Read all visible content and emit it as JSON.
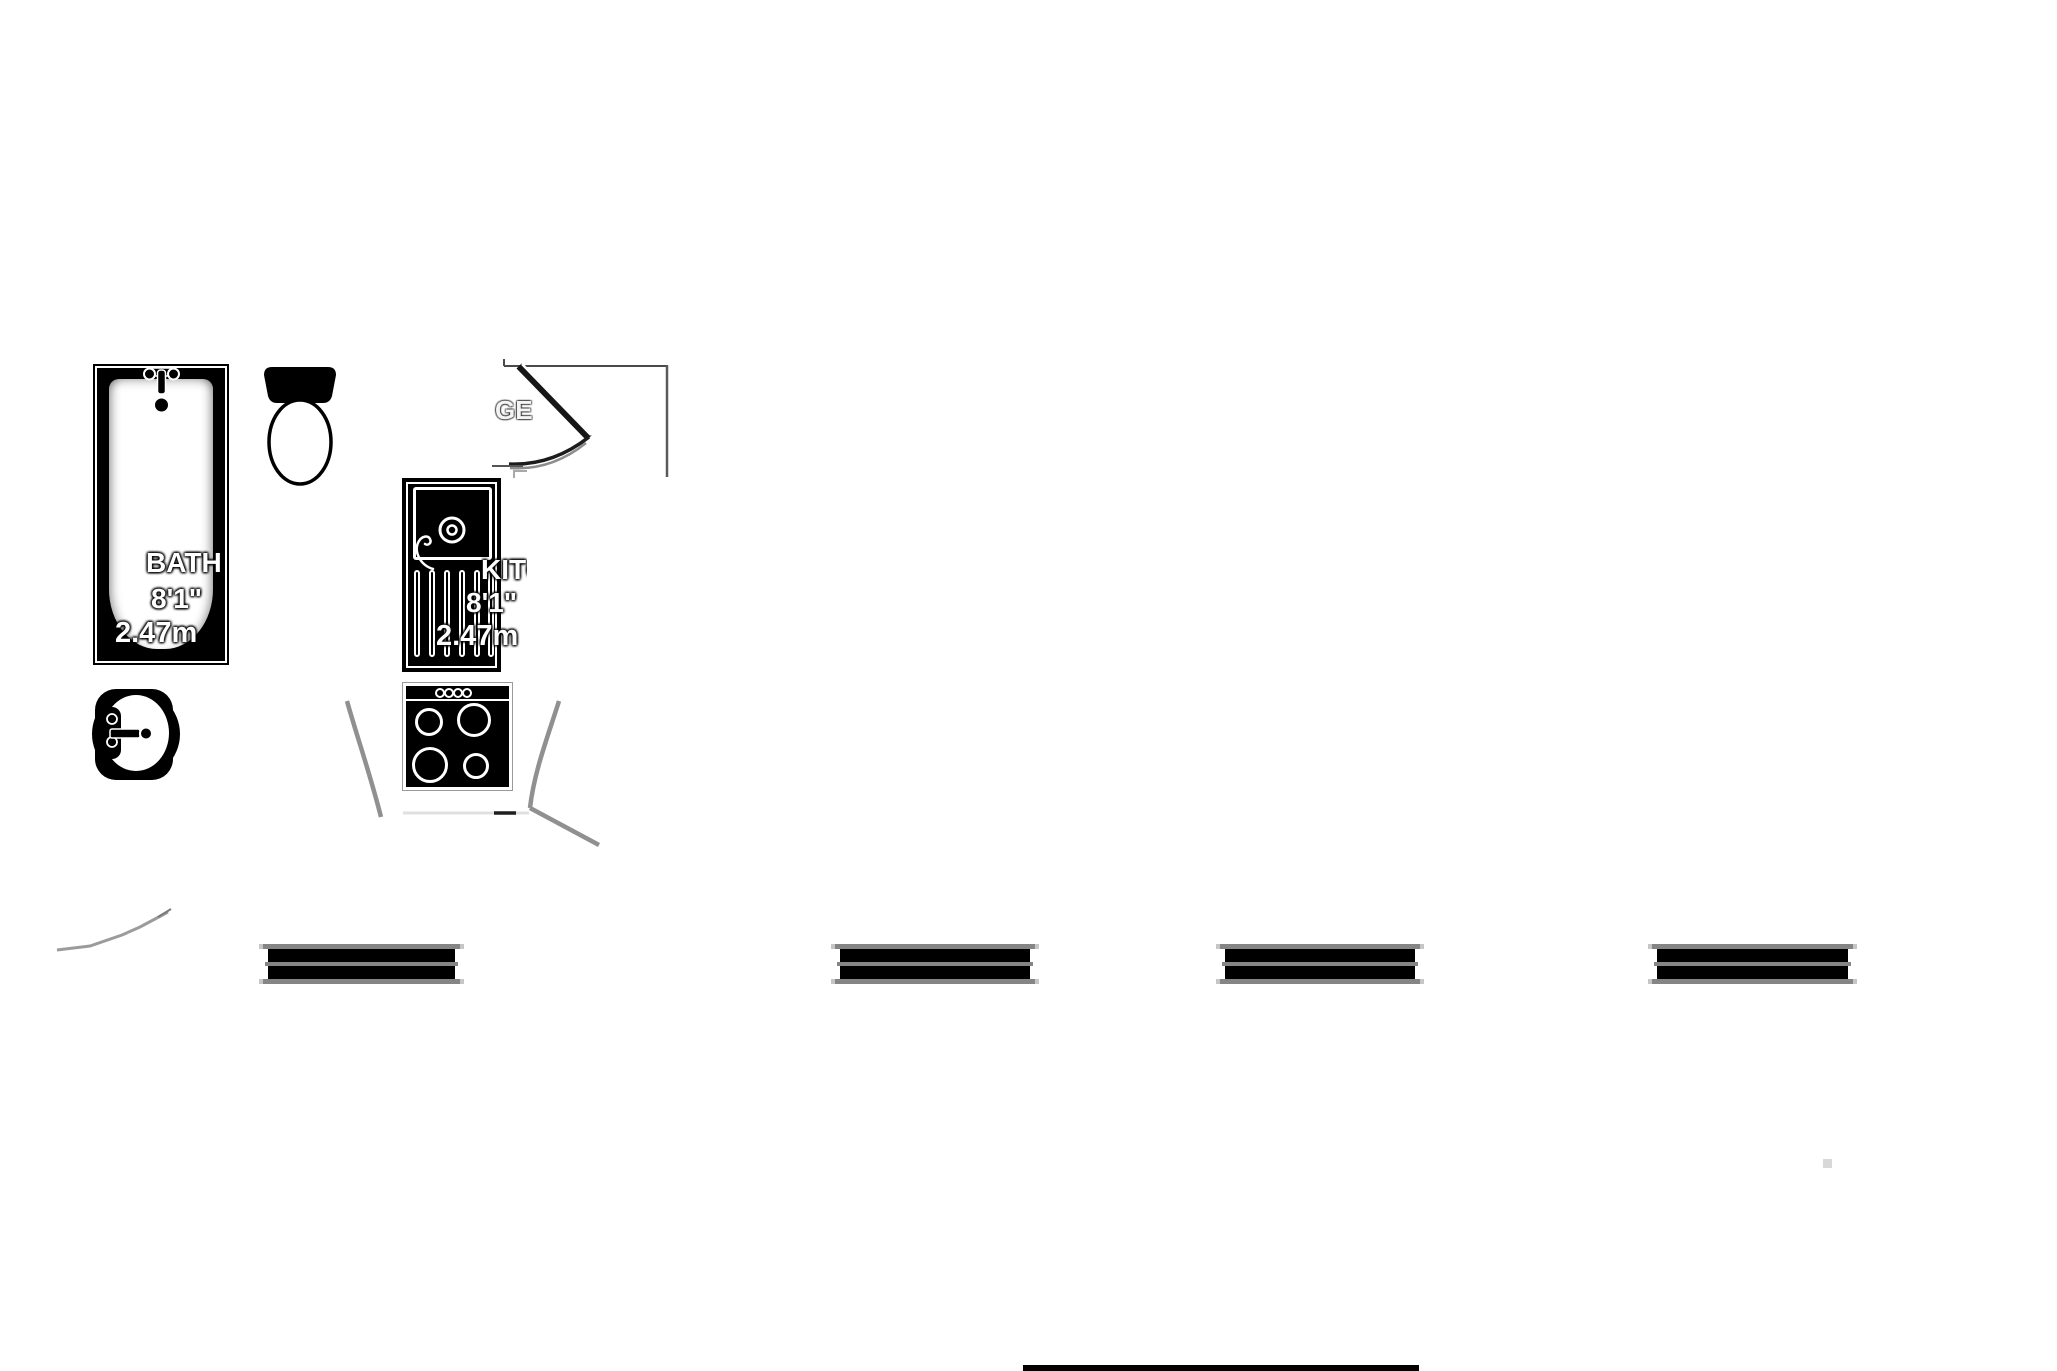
{
  "page": {
    "background": "#ffffff",
    "kind": "floor-plan-fragment"
  },
  "labels": {
    "bath": {
      "name": "BATH",
      "size_imperial": "8'1\"",
      "size_metric": "2.47m"
    },
    "kitchen": {
      "name": "KITCHEN",
      "size_imperial": "8'1\"",
      "size_metric": "2.47m"
    },
    "stairs_fragment": "GE"
  },
  "fixtures": {
    "types": [
      "bathtub",
      "toilet",
      "wash-basin",
      "kitchen-sink-drainer",
      "cooker-hob",
      "staircase",
      "door-swing-arc",
      "window-symbol",
      "wall-line"
    ],
    "window_count": 4,
    "burner_count": 4,
    "knob_count": 4
  },
  "colors": {
    "fixture_line": "#000000",
    "window_rail": "#858585",
    "window_cap": "#c6c6c6",
    "door_arc": "#909090",
    "stray_dot": "#d8d8d8",
    "background": "#ffffff"
  }
}
